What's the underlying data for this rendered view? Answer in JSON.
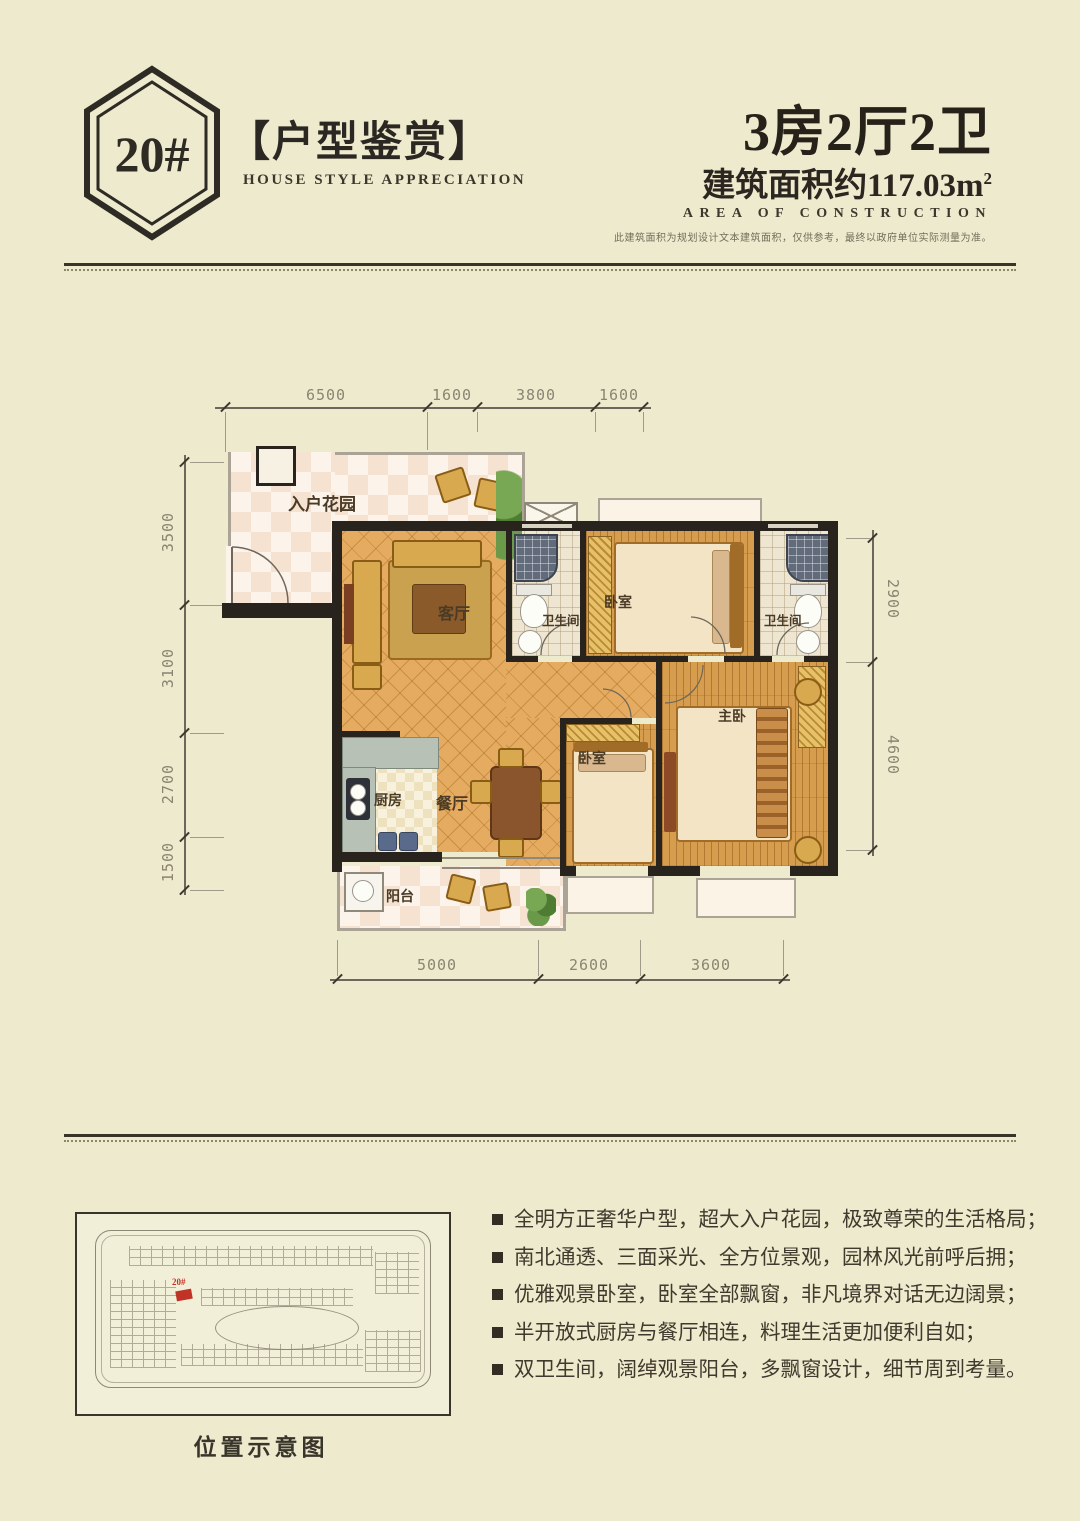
{
  "colors": {
    "background": "#edeacd",
    "ink": "#2b2620",
    "wall": "#29231e",
    "tile_floor": "#e5ab60",
    "wood_floor": "#d79d4e",
    "dim_text": "#8b8472",
    "marker_red": "#c13326"
  },
  "header": {
    "badge": "20#",
    "title": "【户型鉴赏】",
    "subtitle": "HOUSE STYLE APPRECIATION",
    "unit_type": "3房2厅2卫",
    "area_prefix": "建筑面积约",
    "area_value": "117.03m",
    "area_sup": "2",
    "area_label": "AREA OF CONSTRUCTION",
    "disclaimer": "此建筑面积为规划设计文本建筑面积，仅供参考，最终以政府单位实际测量为准。"
  },
  "floorplan": {
    "rooms": {
      "entrance": "入户花园",
      "living": "客厅",
      "bath1": "卫生间",
      "bedroom1": "卧室",
      "bath2": "卫生间",
      "master": "主卧",
      "bedroom2": "卧室",
      "kitchen": "厨房",
      "dining": "餐厅",
      "balcony": "阳台"
    },
    "dims": {
      "top": [
        "6500",
        "1600",
        "3800",
        "1600"
      ],
      "left": [
        "3500",
        "3100",
        "2700",
        "1500"
      ],
      "right": [
        "2900",
        "4600"
      ],
      "bottom": [
        "5000",
        "2600",
        "3600"
      ]
    }
  },
  "features": [
    "全明方正奢华户型，超大入户花园，极致尊荣的生活格局；",
    "南北通透、三面采光、全方位景观，园林风光前呼后拥；",
    "优雅观景卧室，卧室全部飘窗，非凡境界对话无边阔景；",
    "半开放式厨房与餐厅相连，料理生活更加便利自如；",
    "双卫生间，阔绰观景阳台，多飘窗设计，细节周到考量。"
  ],
  "map": {
    "marker_label": "20#",
    "caption": "位置示意图"
  }
}
